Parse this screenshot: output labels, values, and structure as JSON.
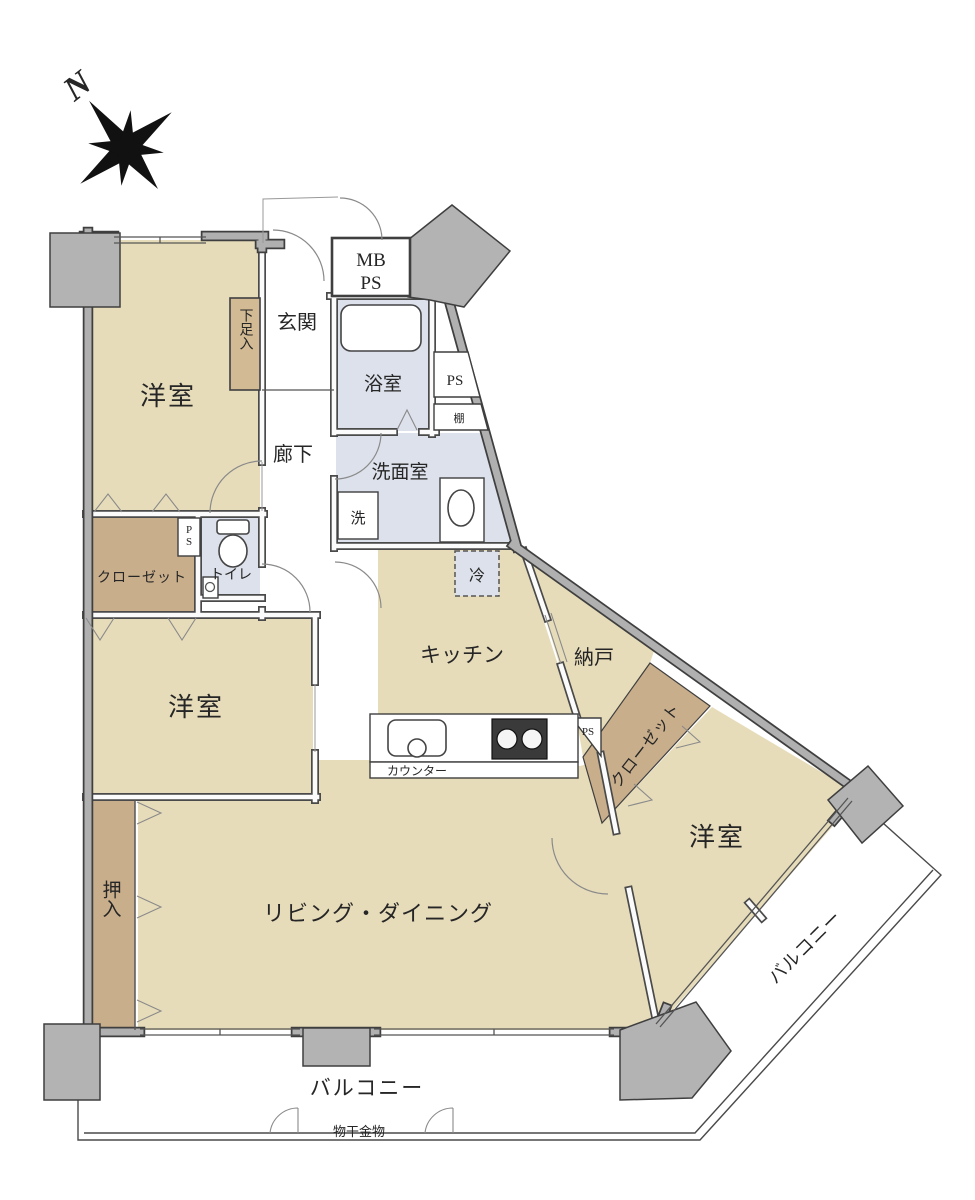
{
  "compass": {
    "north": "N"
  },
  "rooms": {
    "bedroom1": {
      "label": "洋室"
    },
    "bedroom2": {
      "label": "洋室"
    },
    "bedroom3": {
      "label": "洋室"
    },
    "living_dining": {
      "label": "リビング・ダイニング"
    },
    "kitchen": {
      "label": "キッチン"
    },
    "storage_room": {
      "label": "納戸"
    },
    "entrance": {
      "label": "玄関"
    },
    "hallway": {
      "label": "廊下"
    },
    "bathroom": {
      "label": "浴室"
    },
    "washroom": {
      "label": "洗面室"
    },
    "toilet": {
      "label": "トイレ"
    },
    "closet_a": {
      "label": "クローゼット"
    },
    "closet_b": {
      "label": "クローゼット"
    },
    "oshiire": {
      "label": "押入"
    },
    "shoe_box": {
      "label": "下足入"
    },
    "balcony_south": {
      "label": "バルコニー"
    },
    "balcony_east": {
      "label": "バルコニー"
    }
  },
  "fixtures": {
    "mb_ps": {
      "line1": "MB",
      "line2": "PS"
    },
    "ps_shaft_bath": "PS",
    "ps_shaft_toilet": "PS",
    "ps_shaft_counter": "PS",
    "shelf": "棚",
    "washing_machine": "洗",
    "refrigerator": "冷",
    "counter": "カウンター",
    "laundry_hardware": "物干金物"
  },
  "colors": {
    "background": "#ffffff",
    "room_fill": "#e7dcba",
    "closet_fill": "#c9ae8b",
    "wet_area_fill": "#dde1eb",
    "wall_fill": "#b0b0b0",
    "outline": "#3f3f3f"
  }
}
